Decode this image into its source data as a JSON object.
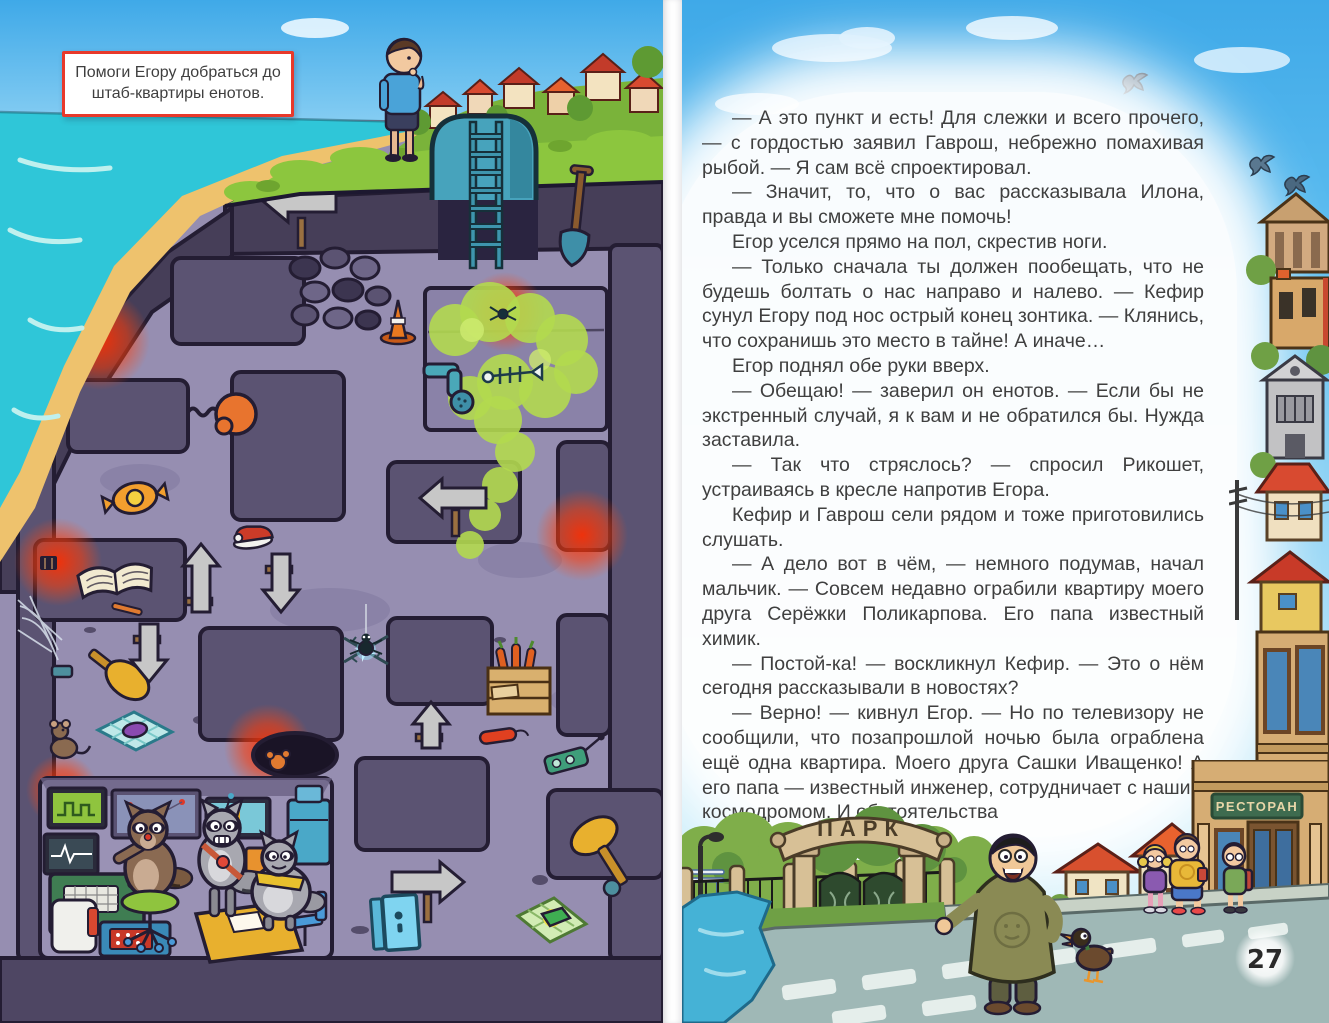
{
  "spread": {
    "type": "children-book-spread",
    "left_page": {
      "instruction": "Помоги Егору добраться до штаб-квартиры енотов.",
      "maze_objects": [
        "tunnel-entrance-ladder",
        "shovel",
        "spider-web",
        "direction-arrow-signs",
        "stone-rubble-wall",
        "traffic-cone",
        "toxic-gas-cloud",
        "gas-pipe",
        "fish-skeleton",
        "boxing-glove-trap",
        "candy",
        "red-sneaker",
        "open-book",
        "pencil",
        "mallet-trap",
        "mouse",
        "candy-blanket-trap",
        "barbed-wire-sparks",
        "spider",
        "furnace-glow-vents",
        "pit-hole",
        "carrot-crate",
        "dynamite",
        "detonator",
        "cheese-trap",
        "blue-door",
        "raccoon-headquarters"
      ],
      "characters": [
        "egor",
        "raccoon-at-console",
        "raccoon-standing",
        "raccoon-chubby"
      ]
    },
    "right_page": {
      "paragraphs": [
        "— А это пункт и есть! Для слежки и всего прочего, — с гордостью заявил Гаврош, небрежно помахивая рыбой. — Я сам всё спроектировал.",
        "— Значит, то, что о вас рассказывала Илона, правда и вы сможете мне помочь!",
        "Егор уселся прямо на пол, скрестив ноги.",
        "— Только сначала ты должен пообещать, что не будешь болтать о нас направо и налево. — Кефир сунул Егору под нос острый конец зонтика. — Клянись, что сохранишь это место в тайне! А иначе…",
        "Егор поднял обе руки вверх.",
        "— Обещаю! — заверил он енотов. — Если бы не экстренный случай, я к вам и не обратился бы. Нужда заставила.",
        "— Так что стряслось? — спросил Рикошет, устраиваясь в кресле напротив Егора.",
        "Кефир и Гаврош сели рядом и тоже приготовились слушать.",
        "— А дело вот в чём, — немного подумав, начал мальчик. — Совсем недавно ограбили квартиру моего друга Серёжки Поликарпова. Его папа известный химик.",
        "— Постой-ка! — воскликнул Кефир. — Это о нём сегодня рассказывали в новостях?",
        "— Верно! — кивнул Егор. — Но по телевизору не сообщили, что позапрошлой ночью была ограблена ещё одна квартира. Моего друга Сашки Иващенко! А его папа — известный инженер, сотрудничает с нашим космодромом. И обстоятельства"
      ],
      "signs": {
        "park": "ПАРК",
        "restaurant": "РЕСТОРАН"
      },
      "page_number": "27",
      "scene_objects": [
        "park-gate",
        "iron-fence",
        "pond",
        "bench",
        "lamppost",
        "trees",
        "large-man",
        "duck",
        "three-kids",
        "village-houses",
        "restaurant-building",
        "city-buildings",
        "birds",
        "road-crosswalk"
      ]
    },
    "colors": {
      "sky": "#45aee8",
      "sea": "#2fc6d8",
      "sand": "#eec26d",
      "grass": "#8cc63e",
      "maze_path": "#968eb1",
      "maze_wall": "#5b5372",
      "outline": "#241d33",
      "danger_glow": "#ff3000",
      "gas_green": "#b2d94f",
      "instruction_border": "#e8392b",
      "body_text": "#3f3f3f",
      "road": "#9fb8b6"
    }
  }
}
